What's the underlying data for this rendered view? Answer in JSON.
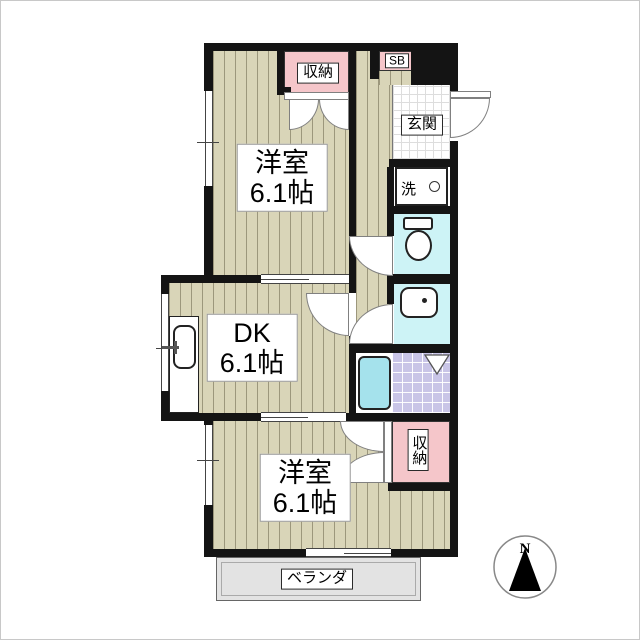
{
  "rooms": {
    "western_top": {
      "name": "洋室",
      "size": "6.1帖"
    },
    "dk": {
      "name": "DK",
      "size": "6.1帖"
    },
    "western_bottom": {
      "name": "洋室",
      "size": "6.1帖"
    }
  },
  "features": {
    "closet_top": "収納",
    "closet_bottom": "収納",
    "shoe_box": "SB",
    "entrance": "玄関",
    "laundry": "洗",
    "veranda": "ベランダ"
  },
  "compass": {
    "north": "N"
  },
  "colors": {
    "wall": "#141414",
    "wood_floor": "#d9d5b8",
    "closet": "#f5c6ca",
    "wet_area": "#cdf3f6",
    "bath_tub": "#a5e2ec",
    "bath_tile": "#c9c5e7",
    "entrance_tile": "#ffffff",
    "veranda": "#e3e3e3"
  }
}
